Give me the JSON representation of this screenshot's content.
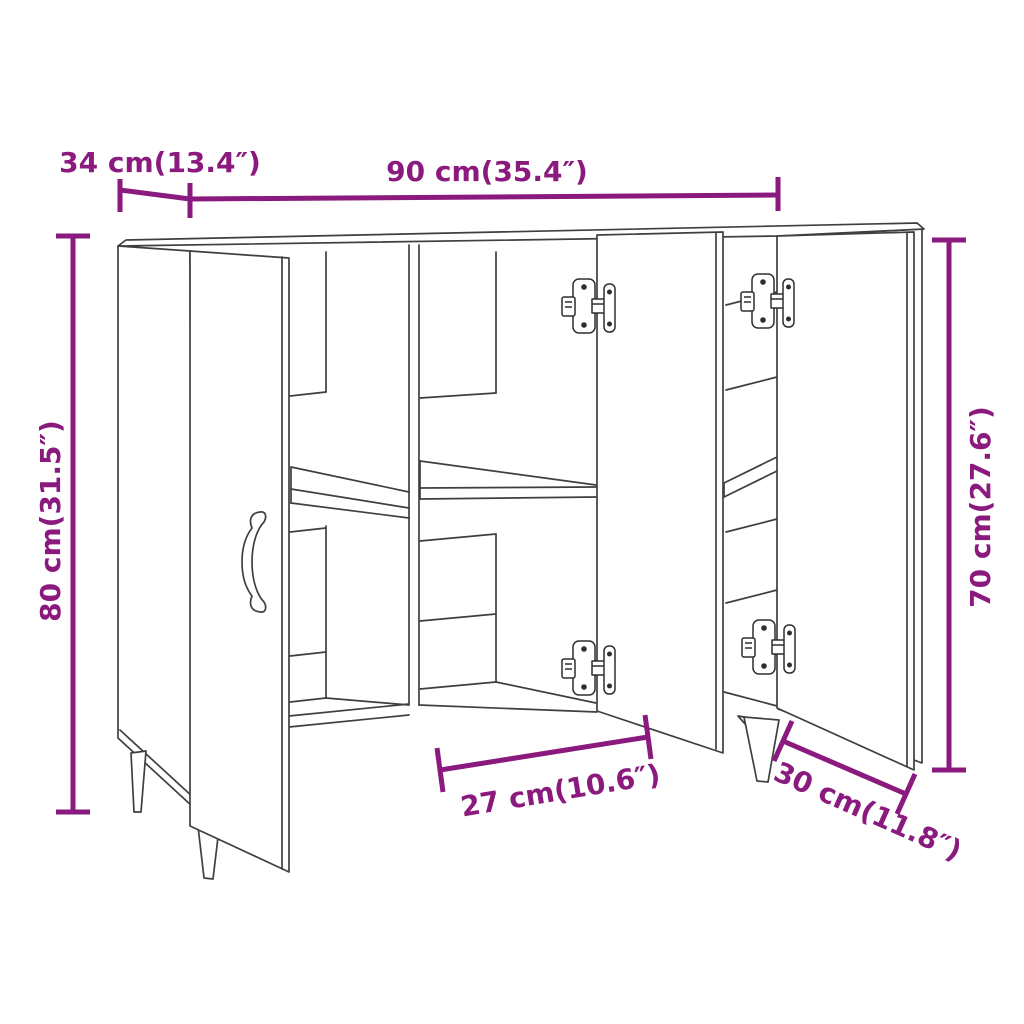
{
  "page": {
    "type": "product-dimension-diagram",
    "subject": "sideboard line drawing with three open doors, shelves, hinges and tapered legs",
    "background": "#ffffff"
  },
  "colors": {
    "dimension_annotation": "#8a1a7d",
    "drawing_line": "#3f3f3f"
  },
  "dimensions": {
    "depth": {
      "label": "34 cm(13.4″)",
      "cm": 34,
      "inches": 13.4
    },
    "width": {
      "label": "90 cm(35.4″)",
      "cm": 90,
      "inches": 35.4
    },
    "total_height": {
      "label": "80 cm(31.5″)",
      "cm": 80,
      "inches": 31.5
    },
    "body_height": {
      "label": "70 cm(27.6″)",
      "cm": 70,
      "inches": 27.6
    },
    "middle_compartment_width": {
      "label": "27 cm(10.6″)",
      "cm": 27,
      "inches": 10.6
    },
    "right_compartment_width": {
      "label": "30 cm(11.8″)",
      "cm": 30,
      "inches": 11.8
    }
  }
}
